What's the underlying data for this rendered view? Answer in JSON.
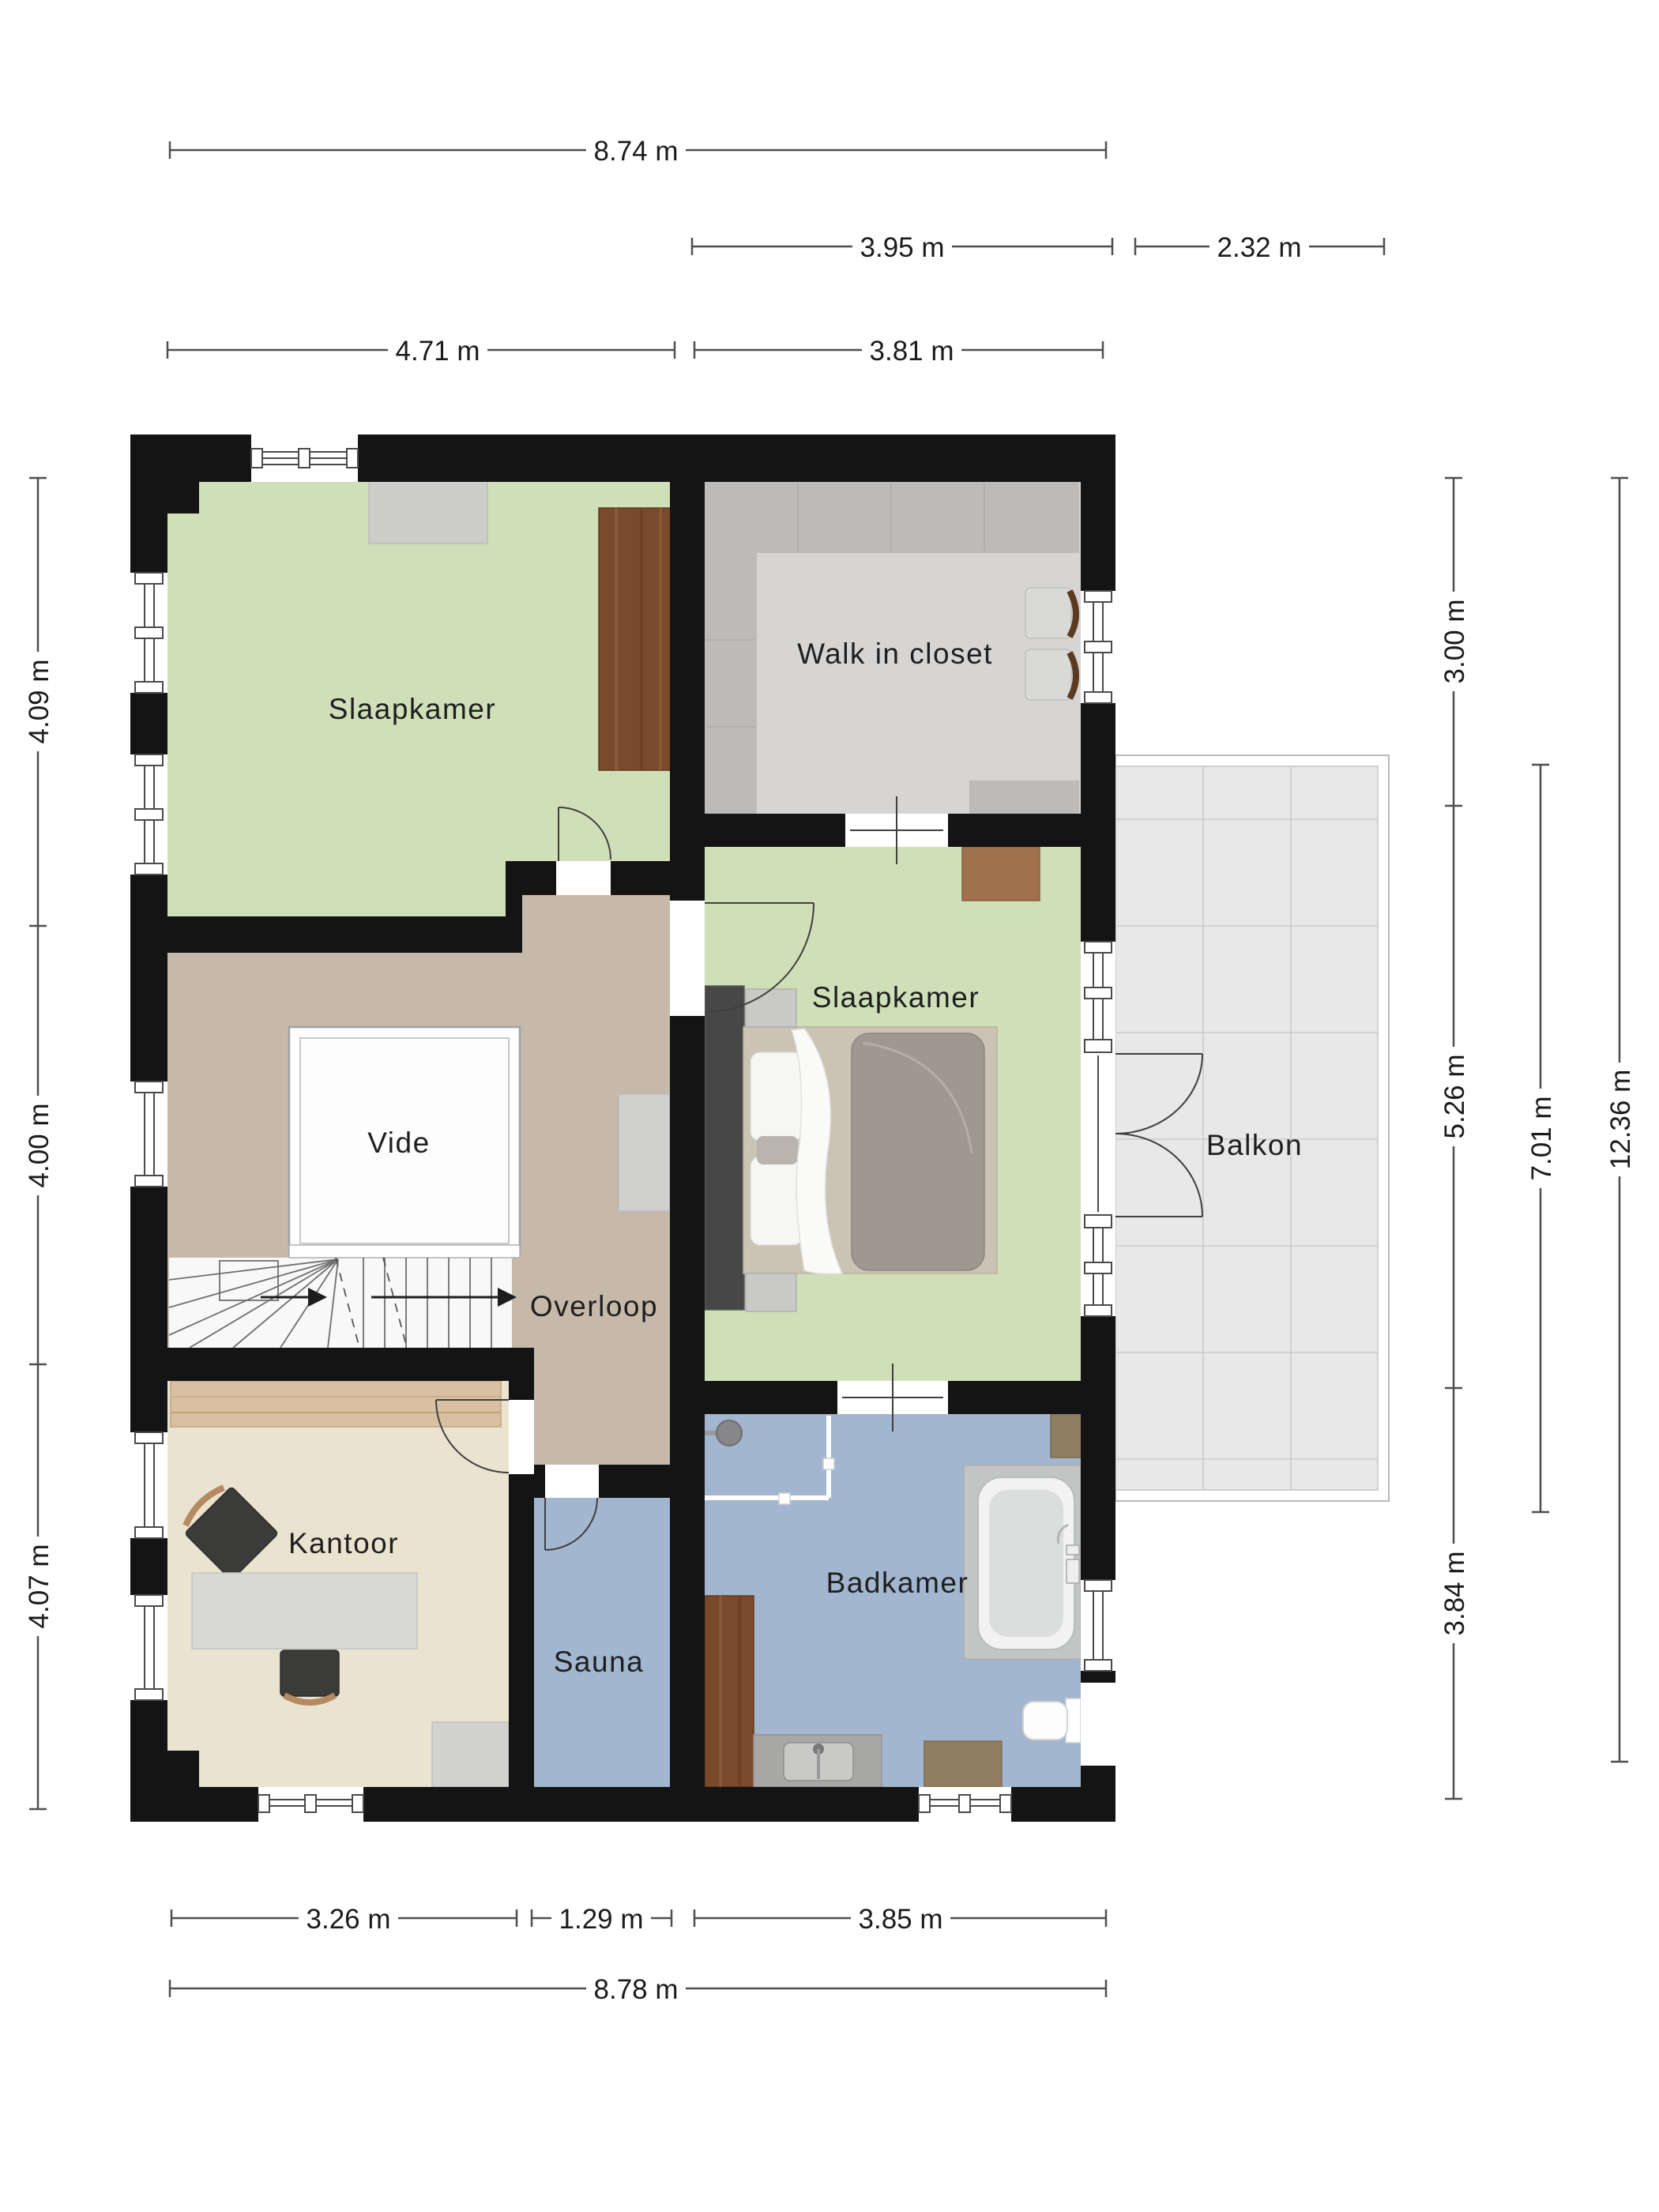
{
  "rooms": {
    "bedroom1": {
      "label": "Slaapkamer",
      "floor_color": "#cfe0b9"
    },
    "walk_in_closet": {
      "label": "Walk in closet",
      "floor_color": "#d6d5d3"
    },
    "bedroom2": {
      "label": "Slaapkamer",
      "floor_color": "#cfe0b9"
    },
    "vide": {
      "label": "Vide",
      "floor_color": "#fdfdfd"
    },
    "overloop": {
      "label": "Overloop",
      "floor_color": "#c6b9aa"
    },
    "kantoor": {
      "label": "Kantoor",
      "floor_color": "#e9e3d0"
    },
    "sauna": {
      "label": "Sauna",
      "floor_color": "#a2b6d0"
    },
    "badkamer": {
      "label": "Badkamer",
      "floor_color": "#a2b6d0"
    },
    "balkon": {
      "label": "Balkon",
      "floor_color": "#e8e8e8"
    }
  },
  "dimensions": {
    "overall_width_top": "8.74 m",
    "closet_width": "3.95 m",
    "balcony_width": "2.32 m",
    "left_section_width": "4.71 m",
    "right_section_width": "3.81 m",
    "left_heights": [
      "4.09 m",
      "4.00 m",
      "4.07 m"
    ],
    "right_heights": [
      "3.00 m",
      "5.26 m",
      "3.84 m"
    ],
    "balcony_height": "7.01 m",
    "overall_height": "12.36 m",
    "bottom_widths": [
      "3.26 m",
      "1.29 m",
      "3.85 m"
    ],
    "overall_width_bottom": "8.78 m"
  },
  "colors": {
    "wall": "#141414",
    "wardrobe_gray": "#bcbbb9",
    "closet_unit_gray": "#cdcdcb",
    "wood_dark": "#7a4a2c",
    "wood_mid": "#a0714a",
    "wood_light": "#d9c0a2",
    "bed_duvet": "#9d9890",
    "bathtub_gray": "#c3c5c4",
    "balcony_tile": "#e8e8e8"
  }
}
